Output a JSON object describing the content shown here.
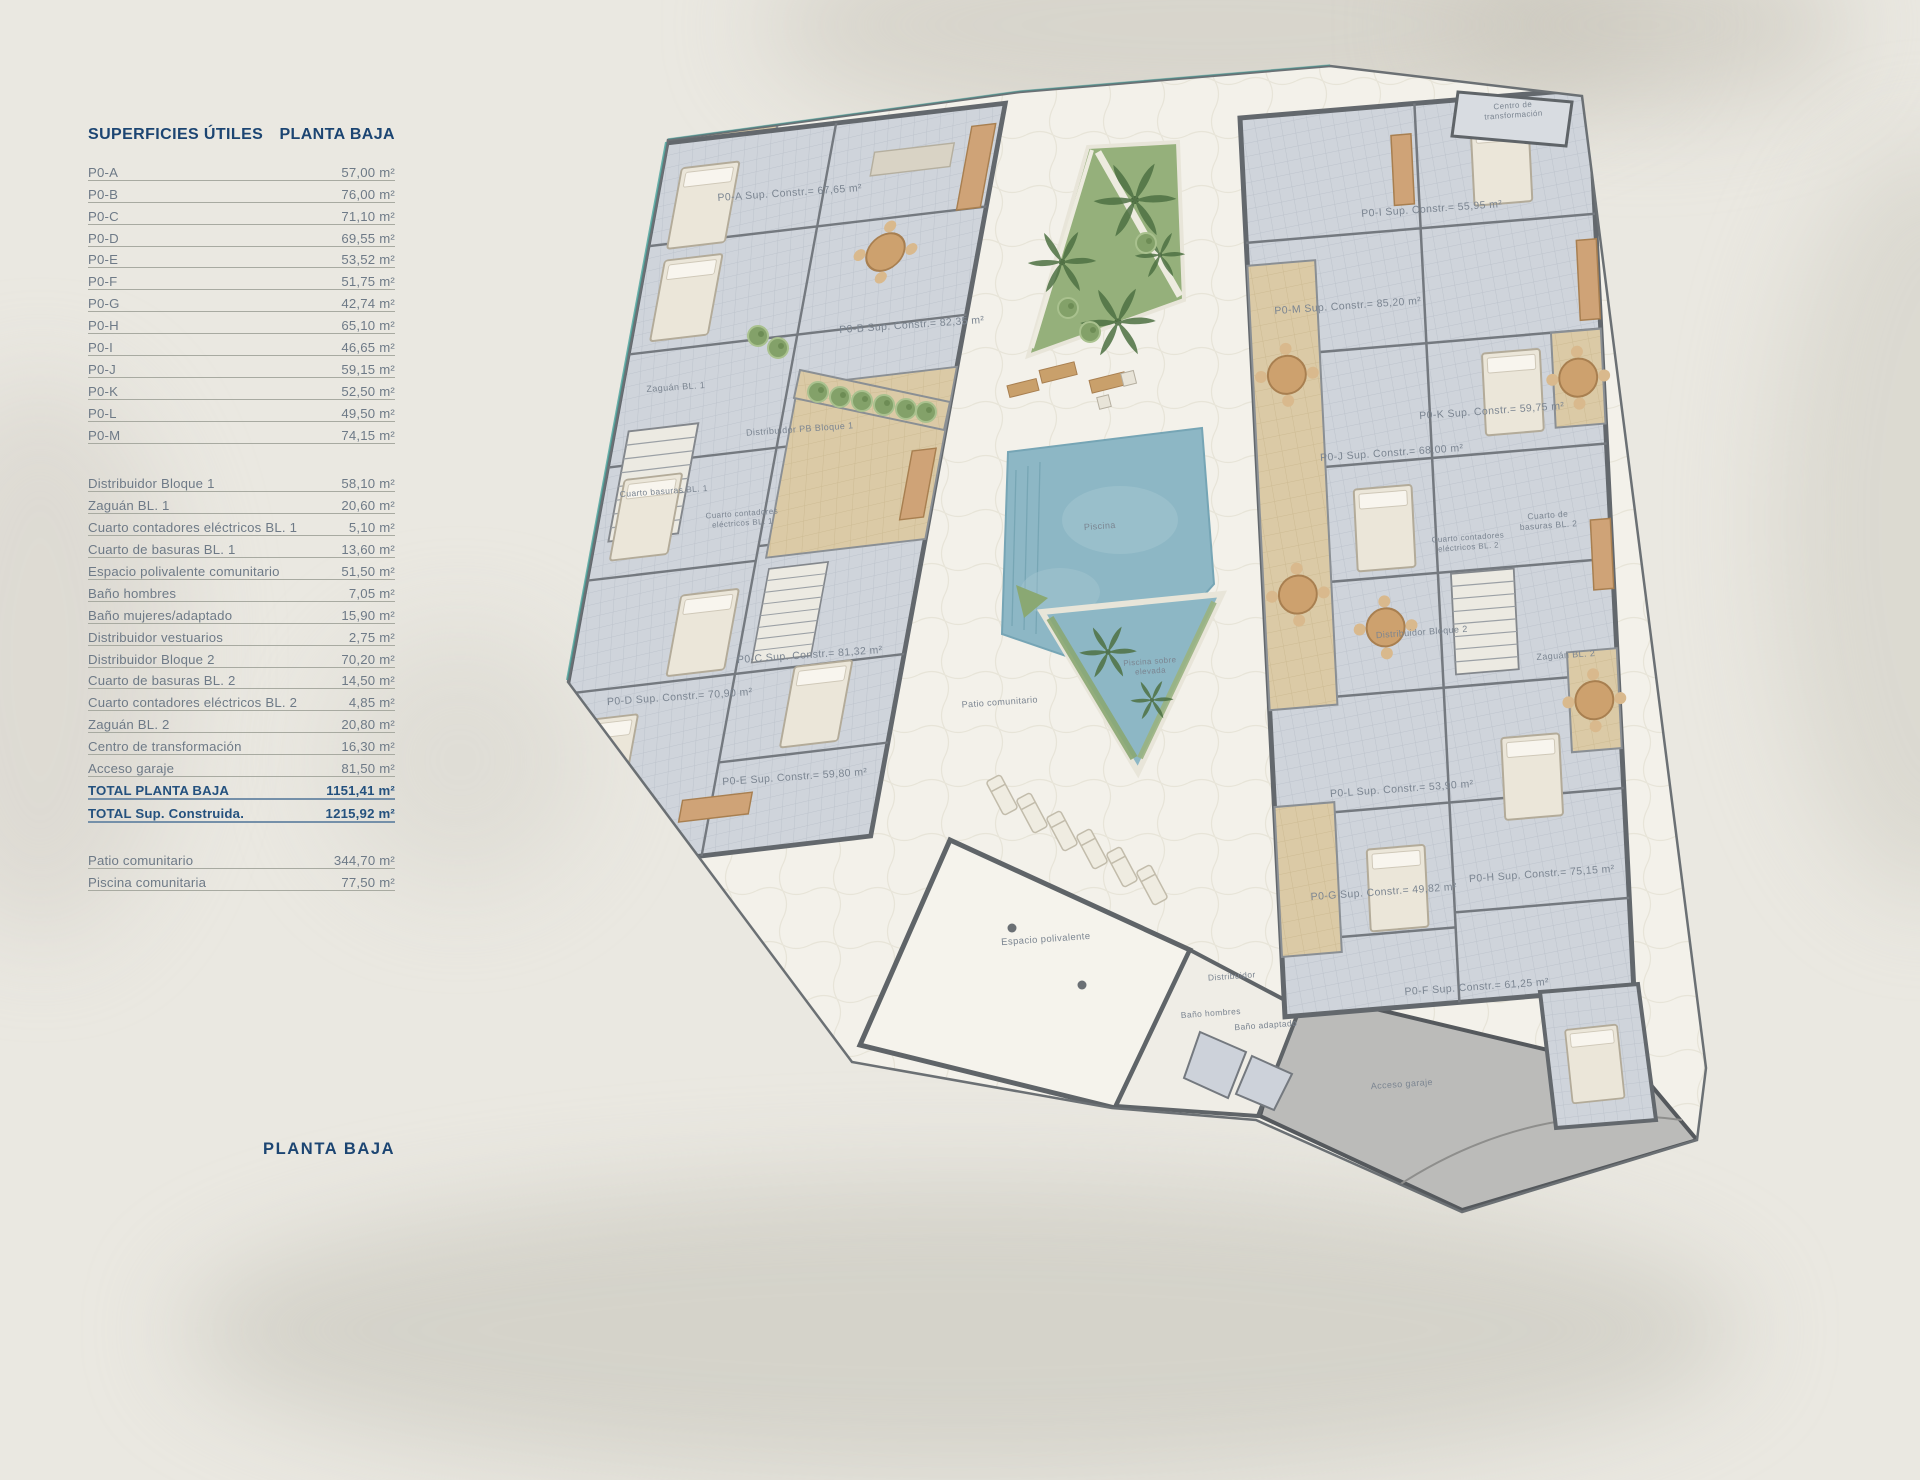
{
  "page": {
    "footer_title": "PLANTA BAJA"
  },
  "table": {
    "title_left": "SUPERFICIES ÚTILES",
    "title_right": "PLANTA BAJA",
    "units": [
      {
        "label": "P0-A",
        "value": "57,00 m²"
      },
      {
        "label": "P0-B",
        "value": "76,00 m²"
      },
      {
        "label": "P0-C",
        "value": "71,10 m²"
      },
      {
        "label": "P0-D",
        "value": "69,55 m²"
      },
      {
        "label": "P0-E",
        "value": "53,52 m²"
      },
      {
        "label": "P0-F",
        "value": "51,75 m²"
      },
      {
        "label": "P0-G",
        "value": "42,74 m²"
      },
      {
        "label": "P0-H",
        "value": "65,10 m²"
      },
      {
        "label": "P0-I",
        "value": "46,65 m²"
      },
      {
        "label": "P0-J",
        "value": "59,15 m²"
      },
      {
        "label": "P0-K",
        "value": "52,50 m²"
      },
      {
        "label": "P0-L",
        "value": "49,50 m²"
      },
      {
        "label": "P0-M",
        "value": "74,15 m²"
      }
    ],
    "commons": [
      {
        "label": "Distribuidor Bloque 1",
        "value": "58,10 m²"
      },
      {
        "label": "Zaguán BL. 1",
        "value": "20,60 m²"
      },
      {
        "label": "Cuarto contadores eléctricos BL. 1",
        "value": "5,10 m²"
      },
      {
        "label": "Cuarto de basuras BL. 1",
        "value": "13,60 m²"
      },
      {
        "label": "Espacio polivalente comunitario",
        "value": "51,50 m²"
      },
      {
        "label": "Baño hombres",
        "value": "7,05 m²"
      },
      {
        "label": "Baño mujeres/adaptado",
        "value": "15,90 m²"
      },
      {
        "label": "Distribuidor vestuarios",
        "value": "2,75 m²"
      },
      {
        "label": "Distribuidor Bloque 2",
        "value": "70,20 m²"
      },
      {
        "label": "Cuarto de basuras BL. 2",
        "value": "14,50 m²"
      },
      {
        "label": "Cuarto contadores eléctricos BL. 2",
        "value": "4,85 m²"
      },
      {
        "label": "Zaguán BL. 2",
        "value": "20,80 m²"
      },
      {
        "label": "Centro de transformación",
        "value": "16,30 m²"
      },
      {
        "label": "Acceso garaje",
        "value": "81,50 m²"
      },
      {
        "label": "TOTAL PLANTA BAJA",
        "value": "1151,41 m²",
        "strong": true
      },
      {
        "label": "TOTAL Sup. Construida.",
        "value": "1215,92 m²",
        "strong": true
      }
    ],
    "outdoor": [
      {
        "label": "Patio comunitario",
        "value": "344,70 m²"
      },
      {
        "label": "Piscina comunitaria",
        "value": "77,50 m²"
      }
    ]
  },
  "plan": {
    "label_color": "#7b8591",
    "label_rotation": -4,
    "labels": [
      {
        "lines": [
          "P0-A Sup. Constr.= 67,65 m²"
        ],
        "x": 790,
        "y": 196,
        "s": 10.5
      },
      {
        "lines": [
          "P0-B Sup. Constr.= 82,35 m²"
        ],
        "x": 912,
        "y": 328,
        "s": 10.5
      },
      {
        "lines": [
          "Zaguán BL. 1"
        ],
        "x": 676,
        "y": 390,
        "s": 9
      },
      {
        "lines": [
          "Distribuidor PB Bloque 1"
        ],
        "x": 800,
        "y": 432,
        "s": 9
      },
      {
        "lines": [
          "Cuarto basuras BL. 1"
        ],
        "x": 664,
        "y": 494,
        "s": 8.5
      },
      {
        "lines": [
          "Cuarto contadores",
          "eléctricos BL. 1"
        ],
        "x": 742,
        "y": 516,
        "s": 8
      },
      {
        "lines": [
          "P0-C Sup. Constr.= 81,32 m²"
        ],
        "x": 810,
        "y": 658,
        "s": 10.5
      },
      {
        "lines": [
          "P0-D Sup. Constr.= 70,90 m²"
        ],
        "x": 680,
        "y": 700,
        "s": 10.5
      },
      {
        "lines": [
          "P0-E Sup. Constr.= 59,80 m²"
        ],
        "x": 795,
        "y": 780,
        "s": 10.5
      },
      {
        "lines": [
          "Centro de",
          "transformación"
        ],
        "x": 1513,
        "y": 108,
        "s": 8
      },
      {
        "lines": [
          "P0-I Sup. Constr.= 55,95 m²"
        ],
        "x": 1432,
        "y": 212,
        "s": 10.5
      },
      {
        "lines": [
          "P0-M Sup. Constr.= 85,20 m²"
        ],
        "x": 1348,
        "y": 309,
        "s": 10.5
      },
      {
        "lines": [
          "P0-K Sup. Constr.= 59,75 m²"
        ],
        "x": 1492,
        "y": 414,
        "s": 10.5
      },
      {
        "lines": [
          "P0-J Sup. Constr.= 68,00 m²"
        ],
        "x": 1392,
        "y": 456,
        "s": 10.5
      },
      {
        "lines": [
          "Cuarto de",
          "basuras BL. 2"
        ],
        "x": 1548,
        "y": 518,
        "s": 8.5
      },
      {
        "lines": [
          "Cuarto contadores",
          "eléctricos BL. 2"
        ],
        "x": 1468,
        "y": 540,
        "s": 8
      },
      {
        "lines": [
          "Distribuidor Bloque 2"
        ],
        "x": 1422,
        "y": 635,
        "s": 9
      },
      {
        "lines": [
          "Zaguán BL. 2"
        ],
        "x": 1566,
        "y": 658,
        "s": 9
      },
      {
        "lines": [
          "P0-L Sup. Constr.= 53,90 m²"
        ],
        "x": 1402,
        "y": 792,
        "s": 10.5
      },
      {
        "lines": [
          "P0-G Sup. Constr.= 49,82 m²"
        ],
        "x": 1384,
        "y": 895,
        "s": 10.5
      },
      {
        "lines": [
          "P0-H Sup. Constr.= 75,15 m²"
        ],
        "x": 1542,
        "y": 877,
        "s": 10.5
      },
      {
        "lines": [
          "P0-F Sup. Constr.= 61,25 m²"
        ],
        "x": 1477,
        "y": 990,
        "s": 10.5
      },
      {
        "lines": [
          "Piscina"
        ],
        "x": 1100,
        "y": 529,
        "s": 9
      },
      {
        "lines": [
          "Piscina sobre",
          "elevada"
        ],
        "x": 1150,
        "y": 664,
        "s": 8
      },
      {
        "lines": [
          "Patio comunitario"
        ],
        "x": 1000,
        "y": 705,
        "s": 9
      },
      {
        "lines": [
          "Espacio polivalente"
        ],
        "x": 1046,
        "y": 942,
        "s": 9.5
      },
      {
        "lines": [
          "Distribuidor"
        ],
        "x": 1232,
        "y": 979,
        "s": 8.5
      },
      {
        "lines": [
          "Baño hombres"
        ],
        "x": 1211,
        "y": 1016,
        "s": 8.5
      },
      {
        "lines": [
          "Baño adaptado"
        ],
        "x": 1266,
        "y": 1028,
        "s": 8.5
      },
      {
        "lines": [
          "Acceso garaje"
        ],
        "x": 1402,
        "y": 1087,
        "s": 9
      }
    ]
  },
  "colors": {
    "accent_navy": "#1c4572",
    "row_text": "#6e7a87",
    "wall_gray": "#63686d",
    "tile_gray": "#cfd4db",
    "terrace_tan": "#dbcaa6",
    "garden_green": "#95b07b",
    "pool_blue": "#8db7c5",
    "courtyard": "#f3f1ea",
    "garage_gray": "#bbbbb9"
  }
}
